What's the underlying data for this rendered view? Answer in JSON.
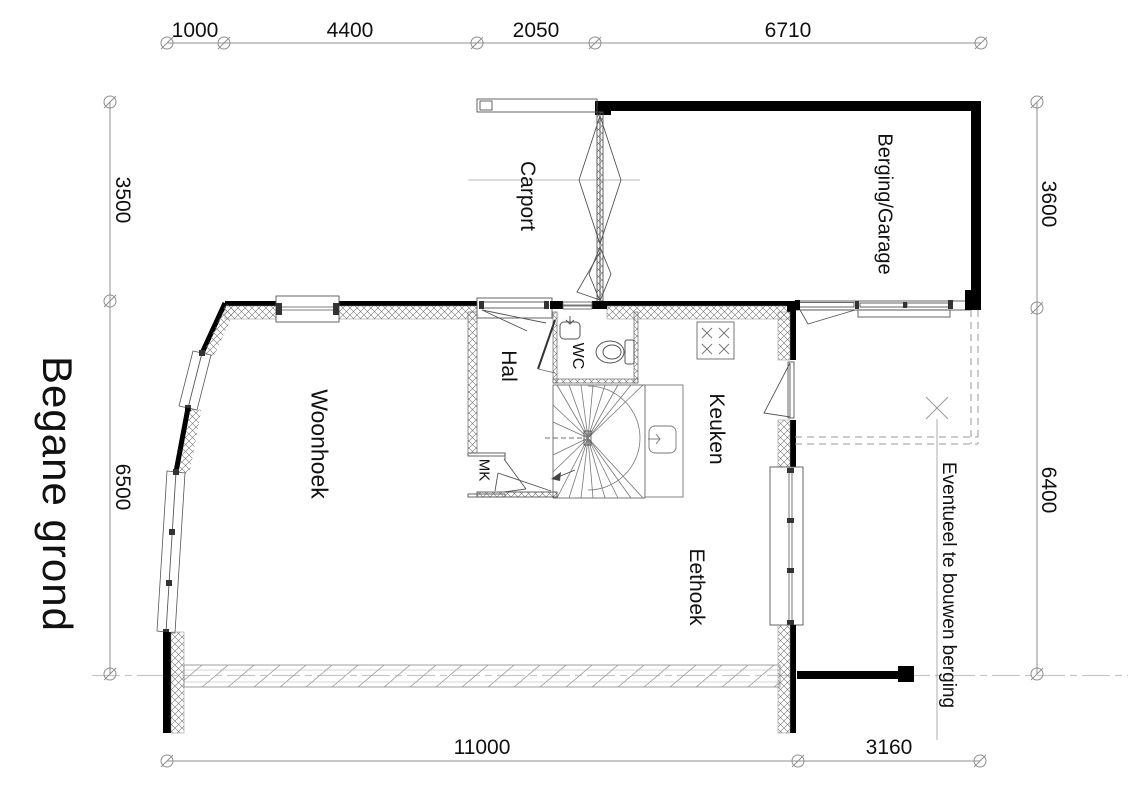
{
  "title": "Begane grond",
  "dimensions": {
    "top": [
      "1000",
      "4400",
      "2050",
      "6710"
    ],
    "bottom": [
      "11000",
      "3160"
    ],
    "left": [
      "3500",
      "6500"
    ],
    "right": [
      "3600",
      "6400"
    ]
  },
  "rooms": {
    "carport": "Carport",
    "berging_garage": "Berging/Garage",
    "hal": "Hal",
    "wc": "WC",
    "mk": "MK",
    "keuken": "Keuken",
    "woonhoek": "Woonhoek",
    "eethoek": "Eethoek"
  },
  "annotations": {
    "future_shed": "Eventueel te bouwen berging"
  },
  "colors": {
    "wall": "#000000",
    "line": "#555555",
    "dimension": "#8f8f8f",
    "centerline": "#d9bfbf",
    "text": "#111111"
  }
}
